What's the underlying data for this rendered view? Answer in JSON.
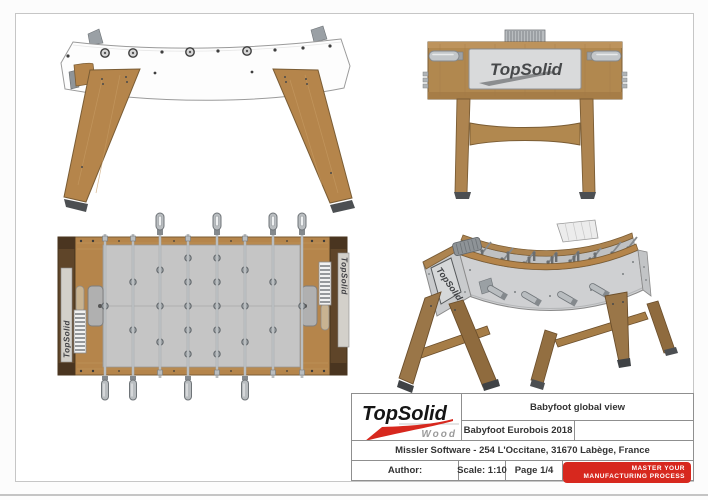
{
  "title_block": {
    "logo": {
      "brand": "TopSolid",
      "edition": "Wood"
    },
    "drawing_title": "Babyfoot global view",
    "project": "Babyfoot Eurobois 2018",
    "company": "Missler Software - 254 L'Occitane, 31670 Labège, France",
    "author_label": "Author:",
    "scale": "Scale: 1:10",
    "page": "Page 1/4",
    "slogan": {
      "line1": "MASTER YOUR",
      "line2": "MANUFACTURING PROCESS"
    }
  },
  "views": {
    "end_elevation": {
      "brand": "TopSolid"
    },
    "top_plan": {
      "left_rail_brand": "TopSolid",
      "right_rail_brand": "TopSolid"
    },
    "perspective": {
      "brand": "TopSolid"
    }
  },
  "colors": {
    "accent_red": "#d7281e",
    "wood": "#b5854b",
    "wood_dark": "#5f4529",
    "panel_white": "#fdfdfd",
    "field_gray": "#c5c5c5",
    "metal_gray": "#b9bdc0",
    "logo_panel_gray": "#d9dadb",
    "frame_gray": "#c6c6c6"
  }
}
